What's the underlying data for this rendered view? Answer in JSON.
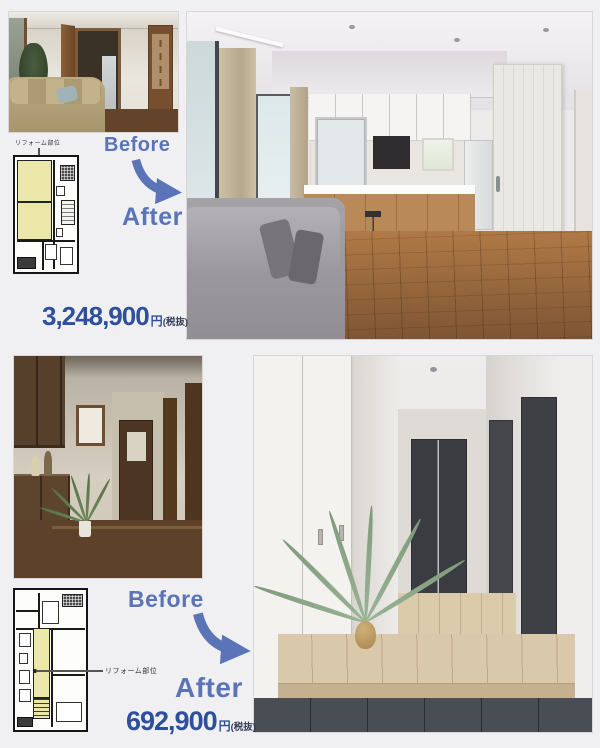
{
  "colors": {
    "background": "#f0f0f2",
    "accent_blue": "#5b74b8",
    "price_blue": "#2e4f9b",
    "plan_highlight": "#ebe7a9"
  },
  "top_case": {
    "plan_label": "リフォーム部位",
    "before_label": "Before",
    "after_label": "After",
    "price": "3,248,900",
    "price_unit": "円",
    "price_note": "(税抜)"
  },
  "bottom_case": {
    "plan_label": "リフォーム部位",
    "before_label": "Before",
    "after_label": "After",
    "price": "692,900",
    "price_unit": "円",
    "price_note": "(税抜)"
  }
}
